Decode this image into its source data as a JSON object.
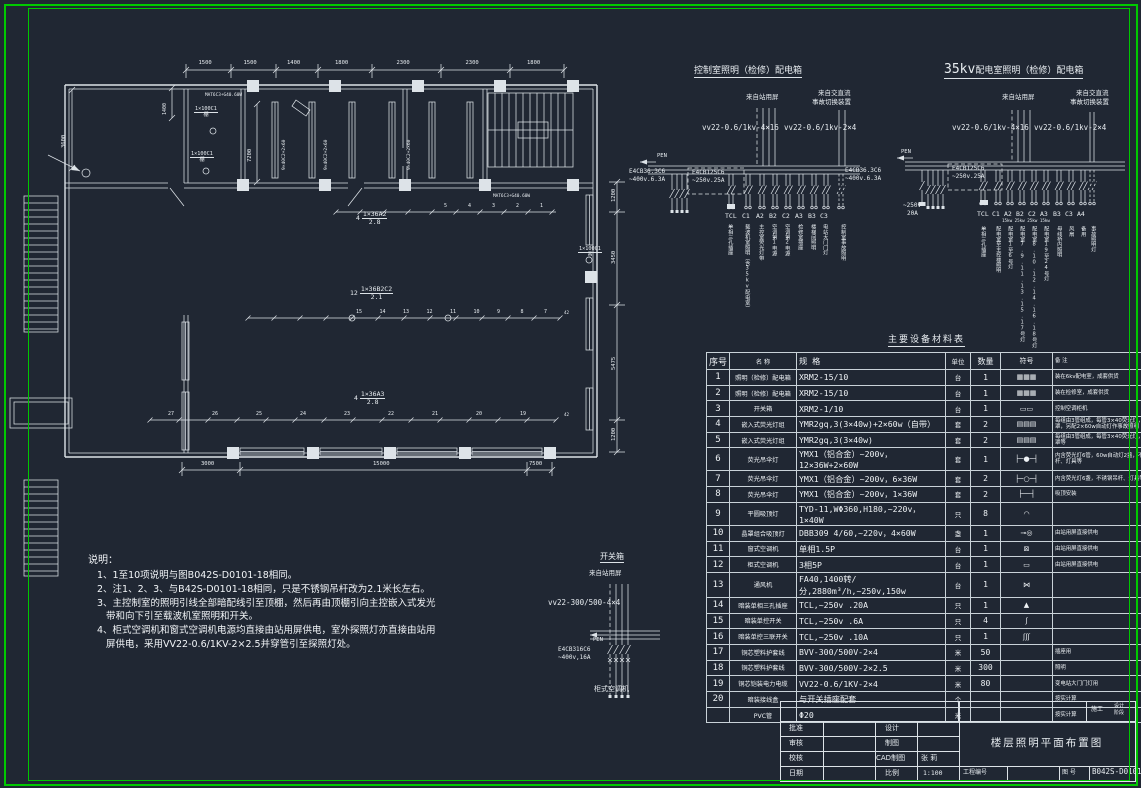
{
  "sheet": {
    "bg": "#202733",
    "frame_color": "#00c800",
    "line_color": "#dde3e8"
  },
  "plan": {
    "dims_top": [
      "1500",
      "1500",
      "1400",
      "1800",
      "2300",
      "2300",
      "1800"
    ],
    "dims_bottom": [
      "3000",
      "15000",
      "7500"
    ],
    "dims_right": [
      "1200",
      "3450",
      "5475",
      "1200"
    ],
    "labels": [
      {
        "t": "3600",
        "x": 62,
        "y": 148,
        "rot": 1,
        "fs": 5.5,
        "m": 1
      },
      {
        "t": "1400",
        "x": 163,
        "y": 115,
        "rot": 1,
        "fs": 5,
        "m": 1
      },
      {
        "t": "7200",
        "x": 248,
        "y": 162,
        "rot": 1,
        "fs": 5.5,
        "m": 1
      },
      {
        "t": "9×40C2+2×60",
        "x": 283,
        "y": 170,
        "rot": 1,
        "fs": 4.6,
        "m": 1
      },
      {
        "t": "9×40C2+2×60",
        "x": 325,
        "y": 170,
        "rot": 1,
        "fs": 4.6,
        "m": 1
      },
      {
        "t": "9×40C2+2×60",
        "x": 408,
        "y": 170,
        "rot": 1,
        "fs": 4.6,
        "m": 1
      },
      {
        "t": "MAT6C3+G40.60W",
        "x": 205,
        "y": 94,
        "fs": 4.4,
        "m": 1
      },
      {
        "t": "MAT6C3+G40.60W",
        "x": 493,
        "y": 195,
        "fs": 4.4,
        "m": 1
      },
      {
        "t": "42",
        "x": 564,
        "y": 311,
        "fs": 4.2,
        "m": 1
      },
      {
        "t": "42",
        "x": 564,
        "y": 413,
        "fs": 4.2,
        "m": 1
      }
    ],
    "frac_labels": [
      {
        "n": "1×100C1",
        "d": "棚",
        "x": 194,
        "y": 107,
        "fs": 5.2
      },
      {
        "n": "1×100C1",
        "d": "棚",
        "x": 190,
        "y": 152,
        "fs": 5.2
      },
      {
        "n": "1×100C1",
        "d": "吊",
        "x": 578,
        "y": 247,
        "fs": 5.2
      },
      {
        "n": "1×36A2",
        "d": "2.8",
        "p": "4",
        "x": 356,
        "y": 211,
        "fs": 6.5
      },
      {
        "n": "1×36B2C2",
        "d": "2.1",
        "p": "12",
        "x": 350,
        "y": 286,
        "fs": 6.5
      },
      {
        "n": "1×36A3",
        "d": "2.8",
        "p": "4",
        "x": 354,
        "y": 391,
        "fs": 6.5
      }
    ],
    "tick_rows": [
      {
        "nums": [
          "5",
          "4",
          "3",
          "2",
          "1"
        ]
      },
      {
        "nums": [
          "15",
          "14",
          "13",
          "12",
          "11",
          "10",
          "9",
          "8",
          "7"
        ]
      },
      {
        "nums": [
          "27",
          "26",
          "25",
          "24",
          "23",
          "22",
          "21",
          "20",
          "19"
        ]
      }
    ]
  },
  "boxA": {
    "title": "控制室照明（检修）配电箱",
    "src1": "来自站用屏",
    "src2a": "来自交直流",
    "src2b": "事故切换装置",
    "cable1": "vv22-0.6/1kv-4×16",
    "cable2": "vv22-0.6/1kv-2×4",
    "pen": "PEN",
    "bkr1a": "E4CB36.3C6",
    "bkr1b": "~400v.6.3A",
    "bkr2a": "E4CB125C6",
    "bkr2b": "~250v.25A",
    "tags": [
      "TCL",
      "C1",
      "A2",
      "B2",
      "C2",
      "A3",
      "B3",
      "C3"
    ],
    "circuits": [
      "单相三孔插座",
      "载波机室照明（含35kv配电室）",
      "主控室荧光灯带",
      "空调第1电源",
      "空调第2电源",
      "检修室插座",
      "楼梯间照明",
      "电站大门门灯",
      "控制室事故照明"
    ]
  },
  "boxB": {
    "title_kv": "35kv",
    "title": "配电室照明（检修）配电箱",
    "src1": "来自站用屏",
    "src2a": "来自交直流",
    "src2b": "事故切换装置",
    "cable1": "vv22-0.6/1kv-4×16",
    "cable2": "vv22-0.6/1kv-2×4",
    "pen": "PEN",
    "bkr1a": "E4CB36.3C6",
    "bkr1b": "~400v.6.3A",
    "bkr2a": "E4CB125C6",
    "bkr2b": "~250v.25A",
    "bkr3a": "~250v",
    "bkr3b": "20A",
    "kw": "15kw 25kw 25kw 15kw",
    "tags": [
      "TCL",
      "C1",
      "A2",
      "B2",
      "C2",
      "A3",
      "B3",
      "C3",
      "A4"
    ],
    "circuits": [
      "单相三孔插座",
      "配电室至主控楼照明",
      "配电室1至6号灯",
      "配电室7.9.11.13.15.17号灯",
      "配电室8.10.12.14.16.18号灯",
      "配电室19至24号灯",
      "母线桥内照明",
      "风扇",
      "备用",
      "事故照明灯"
    ]
  },
  "boxC": {
    "title": "开关箱",
    "src": "来自站用屏",
    "cable": "vv22-300/500-4×4",
    "pen": "PEN",
    "bkr1": "E4CB316C6",
    "bkr2": "~400v,16A",
    "load": "柜式空调机"
  },
  "notes": {
    "title": "说明：",
    "lines": [
      "1、1至10项说明与图B042S-D0101-18相同。",
      "2、注1、2、3、与B42S-D0101-18相同，只是不锈钢吊杆改为2.1米长左右。",
      "3、主控制室的照明引线全部暗配线引至顶棚，然后再由顶棚引向主控嵌入式发光",
      "带和向下引至载波机室照明和开关。",
      "4、柜式空调机和窗式空调机电源均直接由站用屏供电，室外探照灯亦直接由站用",
      "屏供电，采用VV22-0.6/1KV-2×2.5并穿管引至探照灯处。"
    ]
  },
  "table": {
    "title": "主要设备材料表",
    "headers": [
      "序号",
      "名 称",
      "规 格",
      "单位",
      "数量",
      "符号",
      "备 注"
    ],
    "rows": [
      [
        "1",
        "照明（检修）配电箱",
        "XRM2-15/10",
        "台",
        "1",
        "▦▦▦",
        "装在6kv配电室，成套供货"
      ],
      [
        "2",
        "照明（检修）配电箱",
        "XRM2-15/10",
        "台",
        "1",
        "▦▦▦",
        "装在检修室，成套供货"
      ],
      [
        "3",
        "开关箱",
        "XRM2-1/10",
        "台",
        "1",
        "▭▭",
        "控制空调柜机"
      ],
      [
        "4",
        "嵌入式荧光灯组",
        "YMR2gq,3(3×40w)+2×60w（自带）",
        "套",
        "2",
        "▤▤▤",
        "每组由3管组成，每管3×40荧光灯，铝合金罩，另配2×60w自动灯作事故照明"
      ],
      [
        "5",
        "嵌入式荧光灯组",
        "YMR2gq,3(3×40w)",
        "套",
        "2",
        "▤▤▤",
        "每组由3管组成，每管3×40荧光灯，铝合金罩等"
      ],
      [
        "6",
        "荧光吊伞灯",
        "YMX1（铝合金）~200v，12×36W+2×60W",
        "套",
        "1",
        "├─●─┤",
        "内含荧光灯6管，60w自动灯2盏，不锈钢吊杆、灯具等"
      ],
      [
        "7",
        "荧光吊伞灯",
        "YMX1（铝合金）~200v，6×36W",
        "套",
        "2",
        "├─○─┤",
        "内含荧光灯6盏，不锈钢吊杆、灯具等"
      ],
      [
        "8",
        "荧光吊伞灯",
        "YMX1（铝合金）~200v，1×36W",
        "套",
        "2",
        "├──┤",
        "吸顶安装"
      ],
      [
        "9",
        "平圆吸顶灯",
        "TYD-11,WΦ360,H180,~220v，1×40W",
        "只",
        "8",
        "◠",
        ""
      ],
      [
        "10",
        "晶罩组合吸顶灯",
        "DBB309 4/60,~220v，4×60W",
        "盏",
        "1",
        "⊸◎",
        "由站用屏直接供电"
      ],
      [
        "11",
        "窗式空调机",
        "单相1.5P",
        "台",
        "1",
        "⊠",
        "由站用屏直接供电"
      ],
      [
        "12",
        "柜式空调机",
        "3相5P",
        "台",
        "1",
        "▭",
        "由站用屏直接供电"
      ],
      [
        "13",
        "通风机",
        "FA40,1400转/分,2880m³/h,~250v,150w",
        "台",
        "1",
        "⋈",
        ""
      ],
      [
        "14",
        "暗装单相三孔插座",
        "TCL,~250v .20A",
        "只",
        "1",
        "▲",
        ""
      ],
      [
        "15",
        "暗装单控开关",
        "TCL,~250v .6A",
        "只",
        "4",
        "ʃ",
        ""
      ],
      [
        "16",
        "暗装单控三联开关",
        "TCL,~250v .10A",
        "只",
        "1",
        "ʃʃʃ",
        ""
      ],
      [
        "17",
        "铜芯塑料护套线",
        "BVV-300/500V-2×4",
        "米",
        "50",
        "",
        "插座用"
      ],
      [
        "18",
        "铜芯塑料护套线",
        "BVV-300/500V-2×2.5",
        "米",
        "300",
        "",
        "照明"
      ],
      [
        "19",
        "铜芯铠装电力电缆",
        "VV22-0.6/1KV-2×4",
        "米",
        "80",
        "",
        "变电站大门门灯用"
      ],
      [
        "20",
        "暗装接线盒",
        "与开关插座配套",
        "个",
        "",
        "",
        "按实计算"
      ],
      [
        "",
        "PVC管",
        "Φ20",
        "米",
        "",
        "",
        "按实计算"
      ]
    ]
  },
  "titleblock": {
    "stage1": "施工",
    "stage2": "设计",
    "stage3": "阶段",
    "l1": "批准",
    "l2": "审核",
    "l3": "校核",
    "l4": "日期",
    "m1": "设计",
    "m2": "制图",
    "m3": "CAD制图",
    "m3v": "张  莉",
    "m4": "比例",
    "m4v": "1:100",
    "title": "楼层照明平面布置图",
    "proj_label": "工程编号",
    "fig_label": "图  号",
    "fig_no": "B042S-D0101-19"
  }
}
